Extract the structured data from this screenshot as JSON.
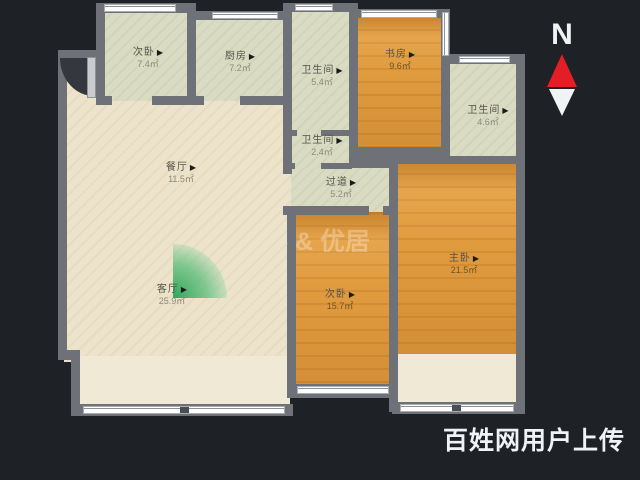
{
  "plan": {
    "kind": "apartment-floorplan",
    "colors": {
      "background": "#1e2126",
      "wall": "#6e7278",
      "floor_living": "#ece3ca",
      "floor_service": "#d9dcc2",
      "floor_wood": "#e19b3f",
      "floor_balcony": "#efe9d6",
      "plant_green": "#26a454",
      "needle_red": "#e31e24",
      "window_white": "#fdfdfe"
    }
  },
  "rooms": [
    {
      "id": "bedroom-a",
      "name": "次卧",
      "area": "7.4㎡"
    },
    {
      "id": "kitchen",
      "name": "厨房",
      "area": "7.2㎡"
    },
    {
      "id": "bath-1",
      "name": "卫生间",
      "area": "5.4㎡"
    },
    {
      "id": "study",
      "name": "书房",
      "area": "9.6㎡"
    },
    {
      "id": "bath-2",
      "name": "卫生间",
      "area": "2.4㎡"
    },
    {
      "id": "hallway",
      "name": "过道",
      "area": "5.2㎡"
    },
    {
      "id": "bath-3",
      "name": "卫生间",
      "area": "4.6㎡"
    },
    {
      "id": "dining",
      "name": "餐厅",
      "area": "11.5㎡"
    },
    {
      "id": "living",
      "name": "客厅",
      "area": "25.9㎡"
    },
    {
      "id": "bedroom-b",
      "name": "次卧",
      "area": "15.7㎡"
    },
    {
      "id": "master-bedroom",
      "name": "主卧",
      "area": "21.5㎡"
    }
  ],
  "ui": {
    "arrow": "▶"
  },
  "compass": {
    "label": "N"
  },
  "watermarks": {
    "center": "客 & 优居",
    "bottom_right": "百姓网用户上传"
  }
}
